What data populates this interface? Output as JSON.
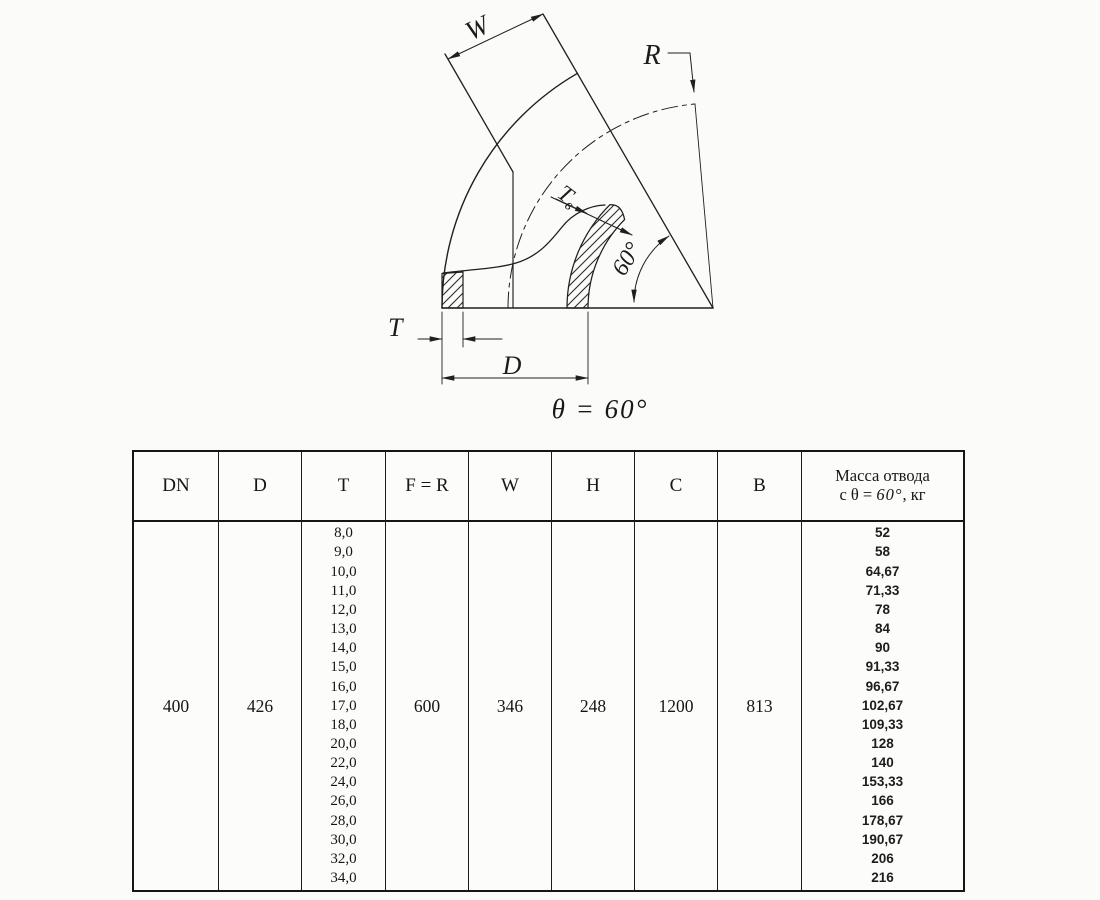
{
  "drawing": {
    "labels": {
      "w": "W",
      "r": "R",
      "tv_main": "Т",
      "tv_sub": "в",
      "angle_arc": "60°",
      "t": "T",
      "d": "D"
    },
    "caption": "θ = 60°",
    "line_color": "#1f1f1f"
  },
  "table": {
    "headers": {
      "dn": "DN",
      "d": "D",
      "t": "T",
      "f_r": "F = R",
      "w": "W",
      "h": "H",
      "c": "C",
      "b": "B",
      "mass_line1": "Масса отвода",
      "mass_prefix": "с θ = ",
      "mass_angle": "60°",
      "mass_suffix": ", кг"
    },
    "row": {
      "dn": "400",
      "d": "426",
      "f_r": "600",
      "w": "346",
      "h": "248",
      "c": "1200",
      "b": "813"
    },
    "t_values": [
      "8,0",
      "9,0",
      "10,0",
      "11,0",
      "12,0",
      "13,0",
      "14,0",
      "15,0",
      "16,0",
      "17,0",
      "18,0",
      "20,0",
      "22,0",
      "24,0",
      "26,0",
      "28,0",
      "30,0",
      "32,0",
      "34,0"
    ],
    "mass_values": [
      "52",
      "58",
      "64,67",
      "71,33",
      "78",
      "84",
      "90",
      "91,33",
      "96,67",
      "102,67",
      "109,33",
      "128",
      "140",
      "153,33",
      "166",
      "178,67",
      "190,67",
      "206",
      "216"
    ]
  }
}
